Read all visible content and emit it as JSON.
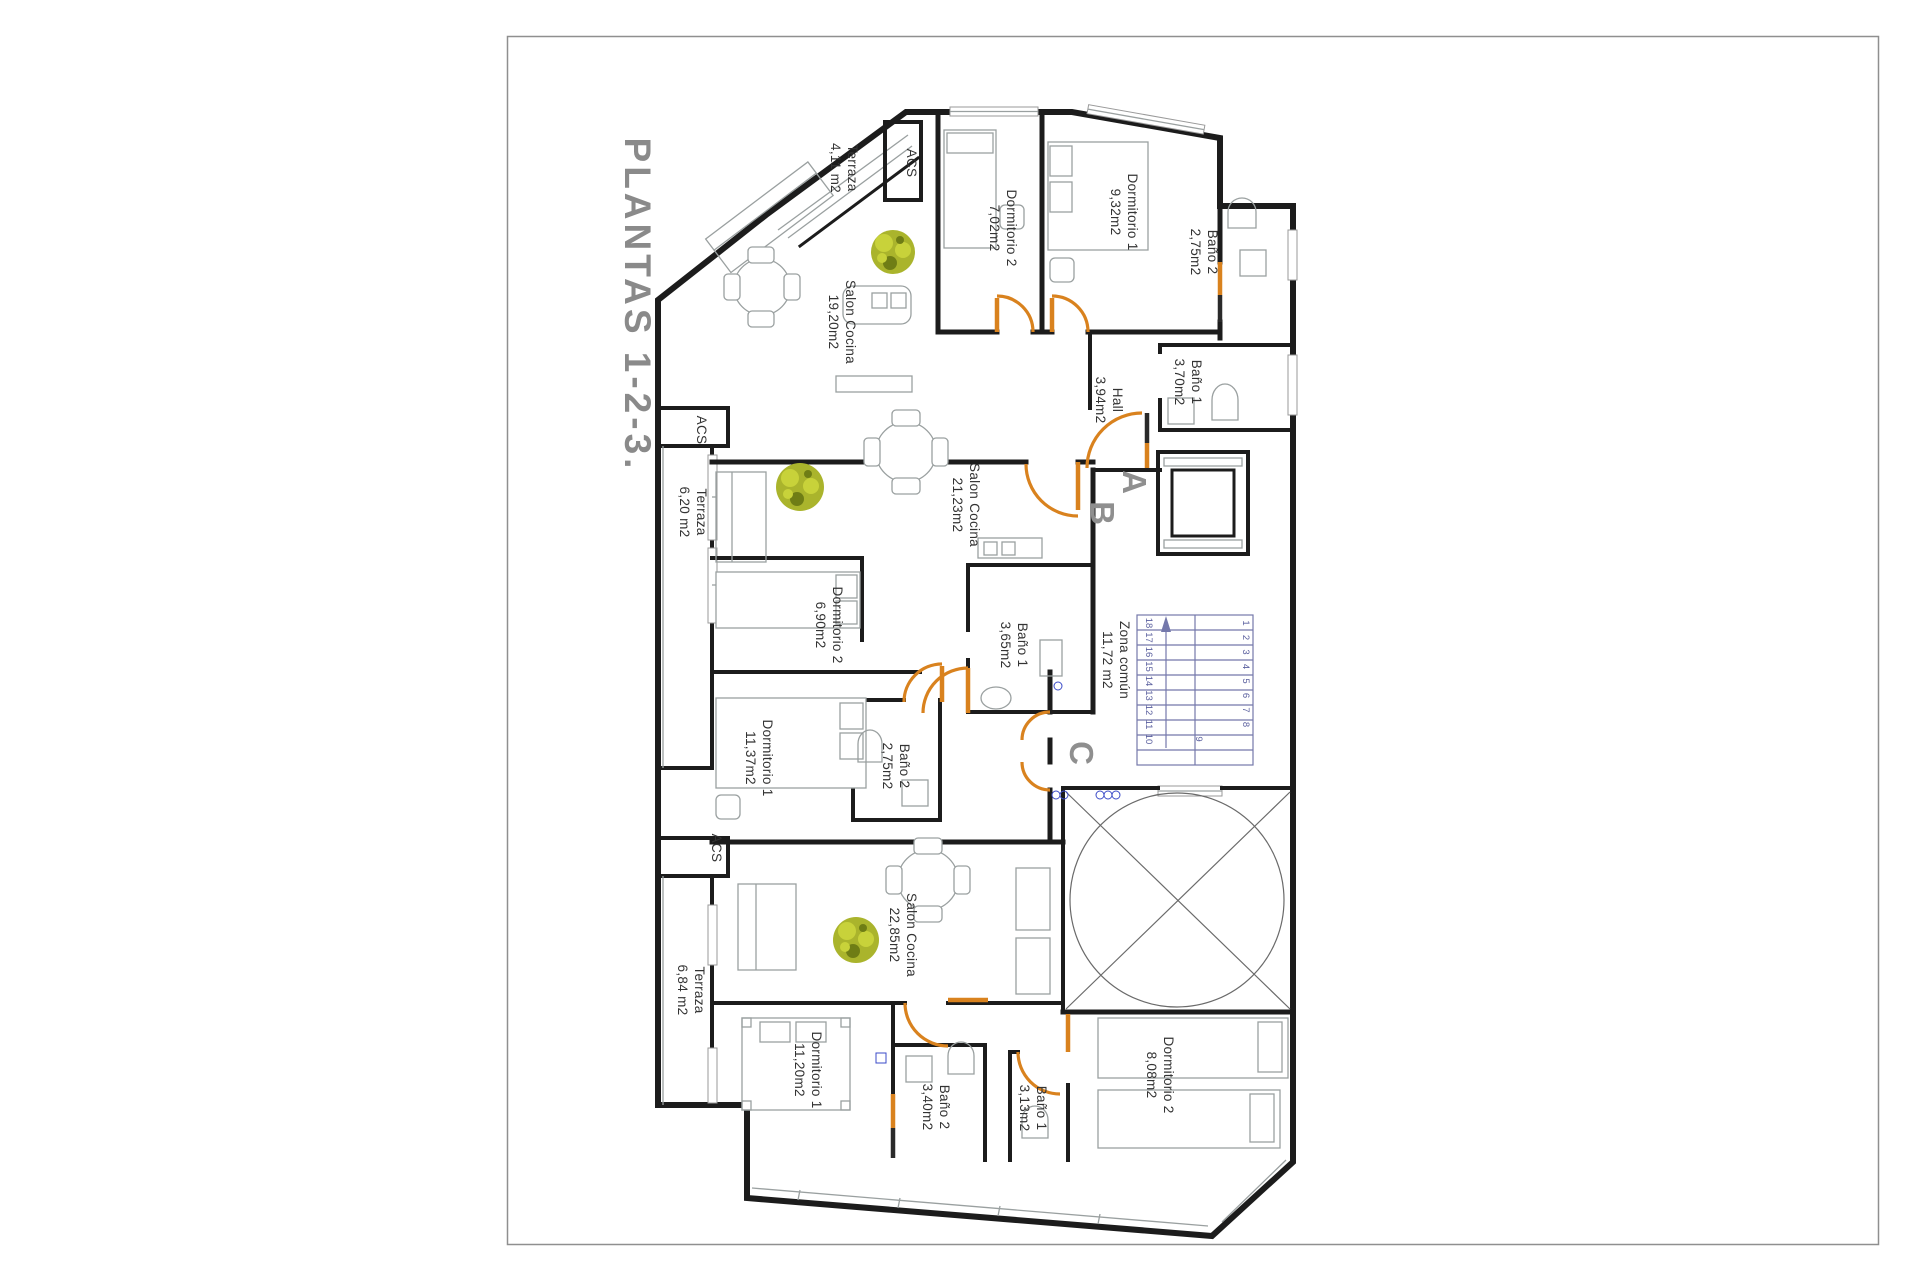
{
  "page": {
    "title": "PLANTAS 1-2-3."
  },
  "units": {
    "a_label": "A",
    "b_label": "B",
    "c_label": "C"
  },
  "rooms": {
    "terraza_a": {
      "name": "Terraza",
      "area": "4,11 m2"
    },
    "acs_a": {
      "name": "ACS"
    },
    "dorm2_a": {
      "name": "Dormitorio 2",
      "area": "7,02m2"
    },
    "dorm1_a": {
      "name": "Dormitorio 1",
      "area": "9,32m2"
    },
    "bano2_a": {
      "name": "Baño 2",
      "area": "2,75m2"
    },
    "salon_a": {
      "name": "Salon Cocina",
      "area": "19,20m2"
    },
    "bano1_a": {
      "name": "Baño 1",
      "area": "3,70m2"
    },
    "hall_a": {
      "name": "Hall",
      "area": "3,94m2"
    },
    "acs_b": {
      "name": "ACS"
    },
    "terraza_b": {
      "name": "Terraza",
      "area": "6,20 m2"
    },
    "salon_b": {
      "name": "Salon Cocina",
      "area": "21,23m2"
    },
    "dorm2_b": {
      "name": "Dormitorio 2",
      "area": "6,90m2"
    },
    "bano1_b": {
      "name": "Baño 1",
      "area": "3,65m2"
    },
    "dorm1_b": {
      "name": "Dormitorio 1",
      "area": "11,37m2"
    },
    "bano2_b": {
      "name": "Baño 2",
      "area": "2,75m2"
    },
    "zona_comun": {
      "name": "Zona común",
      "area": "11,72 m2"
    },
    "salon_c": {
      "name": "Salon Cocina",
      "area": "22,85m2"
    },
    "acs_c": {
      "name": "ACS"
    },
    "terraza_c": {
      "name": "Terraza",
      "area": "6,84 m2"
    },
    "dorm1_c": {
      "name": "Dormitorio 1",
      "area": "11,20m2"
    },
    "bano2_c": {
      "name": "Baño 2",
      "area": "3,40m2"
    },
    "bano1_c": {
      "name": "Baño 1",
      "area": "3,13m2"
    },
    "dorm2_c": {
      "name": "Dormitorio 2",
      "area": "8,08m2"
    }
  },
  "stairs": {
    "col_left": [
      "18",
      "17",
      "16",
      "15",
      "14",
      "13",
      "12",
      "11",
      "10"
    ],
    "col_right": [
      "1",
      "2",
      "3",
      "4",
      "5",
      "6",
      "7",
      "8"
    ],
    "mid": "9"
  },
  "colors": {
    "wall": "#1c1c1c",
    "door": "#d9821e",
    "plant": "#aab42c",
    "stair": "#7478ab",
    "title_gray": "#8a8a8a",
    "furniture_gray": "#9aa0a0"
  }
}
